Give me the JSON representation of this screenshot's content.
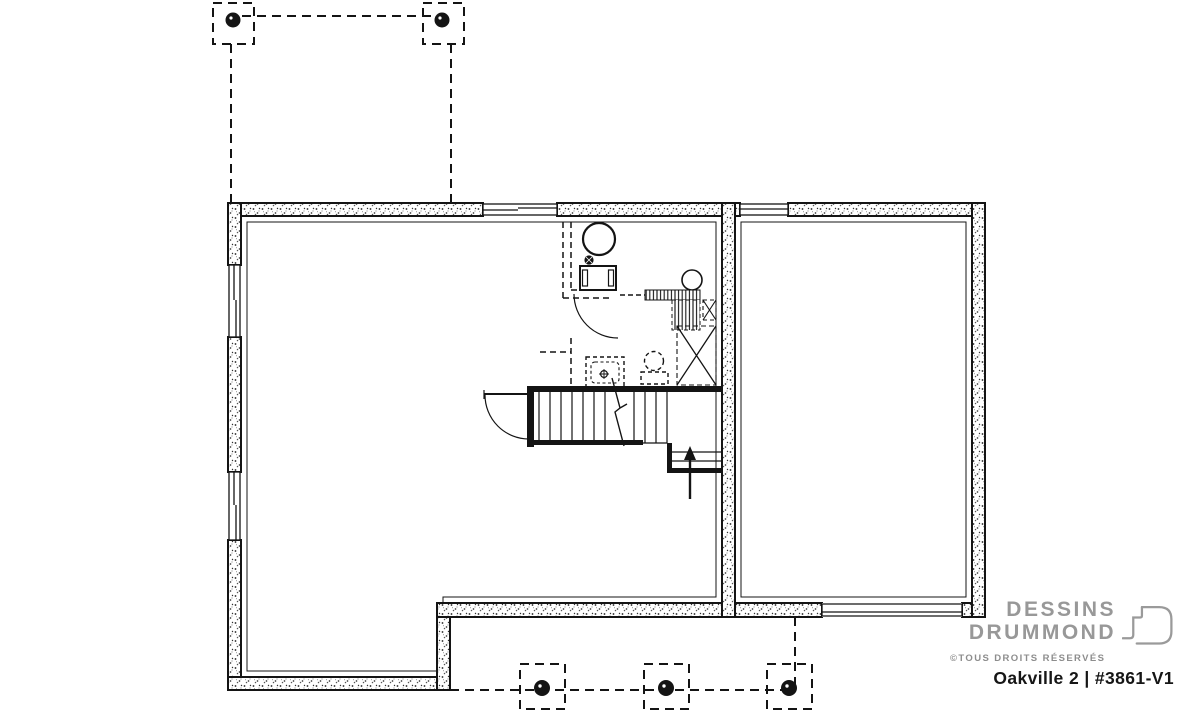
{
  "branding": {
    "logo_line1": "DESSINS",
    "logo_line2": "DRUMMOND",
    "rights_notice": "©TOUS DROITS RÉSERVÉS",
    "plan_title": "Oakville 2 | #3861-V1",
    "logo_mark_icon": "drummond-d-mark"
  },
  "colors": {
    "ink": "#141414",
    "logo_gray": "#989898",
    "title_black": "#161616",
    "background": "#ffffff"
  },
  "drawing": {
    "kind": "basement foundation floor plan",
    "elements": [
      "foundation-walls",
      "windows",
      "garage-door-opening",
      "stairs-with-up-arrow",
      "basement-door",
      "future-bathroom-dashed",
      "water-heater",
      "floor-drain",
      "mechanical-panel",
      "future-toilet",
      "future-shower",
      "future-lavatory",
      "chase-x-boxes",
      "deck-pier-footings-top",
      "deck-pier-footings-bottom"
    ]
  }
}
